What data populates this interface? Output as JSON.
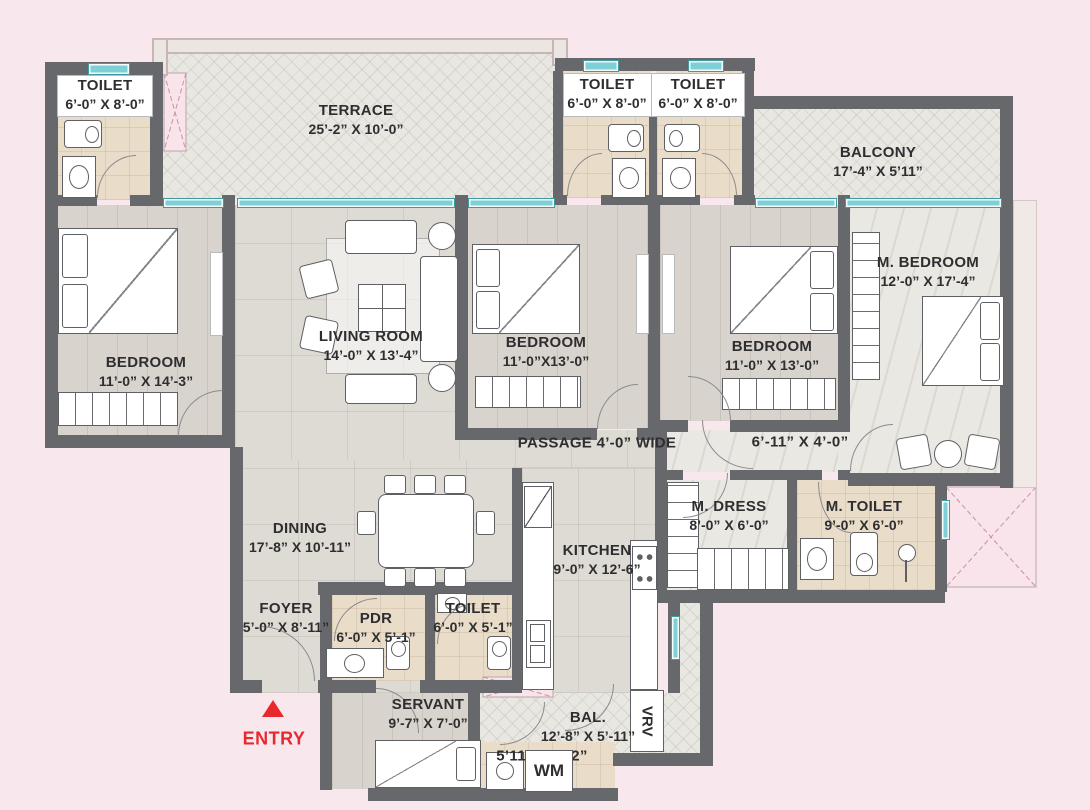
{
  "colors": {
    "background": "#f8e8ee",
    "wall": "#67686b",
    "window_teal": "#7fd0d6",
    "shaft_pink": "#f8e4ea",
    "entry_red": "#e8282f",
    "label_text": "#2e2e30"
  },
  "rooms": {
    "toilet_tl": {
      "name": "TOILET",
      "dims": "6’-0” X 8’-0”"
    },
    "terrace": {
      "name": "TERRACE",
      "dims": "25’-2” X 10’-0”"
    },
    "toilet_m1": {
      "name": "TOILET",
      "dims": "6’-0” X 8’-0”"
    },
    "toilet_m2": {
      "name": "TOILET",
      "dims": "6’-0” X 8’-0”"
    },
    "balcony": {
      "name": "BALCONY",
      "dims": "17’-4” X 5’11”"
    },
    "bedroom1": {
      "name": "BEDROOM",
      "dims": "11’-0” X 14’-3”"
    },
    "living": {
      "name": "LIVING ROOM",
      "dims": "14’-0” X 13’-4”"
    },
    "bedroom2": {
      "name": "BEDROOM",
      "dims": "11’-0”X13’-0”"
    },
    "bedroom3": {
      "name": "BEDROOM",
      "dims": "11’-0” X 13’-0”"
    },
    "m_bedroom": {
      "name": "M. BEDROOM",
      "dims": "12’-0” X 17’-4”"
    },
    "passage": {
      "name": "PASSAGE 4’-0” WIDE"
    },
    "lobby": {
      "dims": "6’-11” X 4’-0”"
    },
    "dining": {
      "name": "DINING",
      "dims": "17’-8” X 10’-11”"
    },
    "kitchen": {
      "name": "KITCHEN",
      "dims": "9’-0” X 12’-6”"
    },
    "m_dress": {
      "name": "M. DRESS",
      "dims": "8’-0” X 6’-0”"
    },
    "m_toilet": {
      "name": "M. TOILET",
      "dims": "9’-0” X 6’-0”"
    },
    "foyer": {
      "name": "FOYER",
      "dims": "5’-0” X 8’-11”"
    },
    "pdr": {
      "name": "PDR",
      "dims": "6’-0” X 5’-1”"
    },
    "toilet_b": {
      "name": "TOILET",
      "dims": "6’-0” X 5’-1”"
    },
    "servant": {
      "name": "SERVANT",
      "dims": "9’-7” X 7’-0”"
    },
    "bal": {
      "name": "BAL.",
      "dims": "12’-8” X 5’-11”"
    },
    "utility": {
      "dims": "5’11” X 1’-2”"
    },
    "wm": {
      "label": "WM"
    },
    "vrv": {
      "label": "VRV"
    }
  },
  "entry": {
    "label": "ENTRY"
  }
}
